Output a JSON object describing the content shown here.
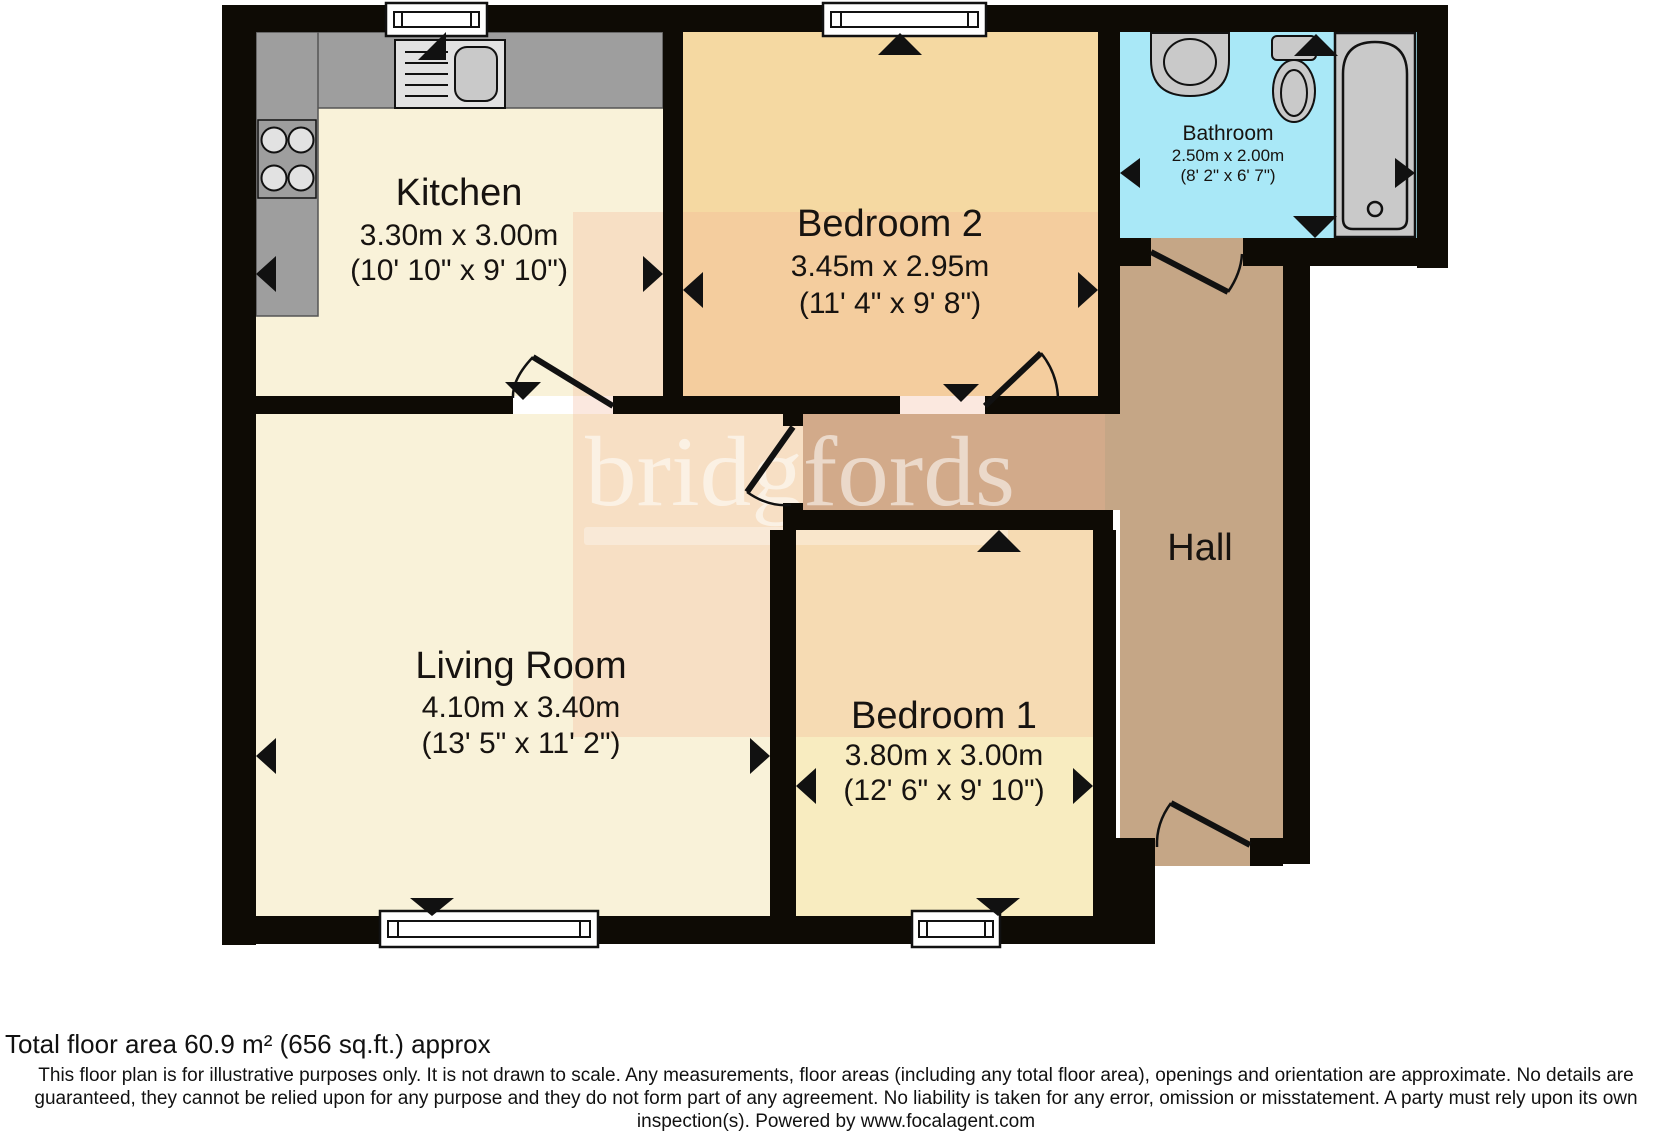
{
  "plan": {
    "rooms": {
      "kitchen": {
        "name": "Kitchen",
        "metric": "3.30m x 3.00m",
        "imperial": "(10' 10\" x 9' 10\")"
      },
      "bedroom2": {
        "name": "Bedroom 2",
        "metric": "3.45m x 2.95m",
        "imperial": "(11' 4\" x 9' 8\")"
      },
      "bathroom": {
        "name": "Bathroom",
        "metric": "2.50m x 2.00m",
        "imperial": "(8' 2\" x 6' 7\")"
      },
      "living": {
        "name": "Living Room",
        "metric": "4.10m x 3.40m",
        "imperial": "(13' 5\" x 11' 2\")"
      },
      "bedroom1": {
        "name": "Bedroom 1",
        "metric": "3.80m x 3.00m",
        "imperial": "(12' 6\" x 9' 10\")"
      },
      "hall": {
        "name": "Hall"
      }
    },
    "watermark": {
      "text": "bridgfords"
    },
    "colors": {
      "wall": "#0e0b05",
      "kitchen_living": "#f9f2d9",
      "bedroom2": "#f5d9a2",
      "bedroom1": "#f8ecc0",
      "bathroom": "#a9e8f7",
      "hall": "#c5a686",
      "counter": "#9e9e9e",
      "sink_unit": "#e2e2e2",
      "fixture": "#c9c9c9",
      "watermark_wash": "rgba(243,178,148,0.30)",
      "watermark_text": "#ffffff"
    }
  },
  "footer": {
    "total_area": "Total floor area 60.9 m² (656 sq.ft.) approx",
    "disclaimer": "This floor plan is for illustrative purposes only. It is not drawn to scale. Any measurements, floor areas (including any total floor area), openings and orientation are approximate. No details are guaranteed, they cannot be relied upon for any purpose and they do not form part of any agreement. No liability is taken for any error, omission or misstatement. A party must rely upon its own inspection(s). Powered by www.focalagent.com"
  }
}
